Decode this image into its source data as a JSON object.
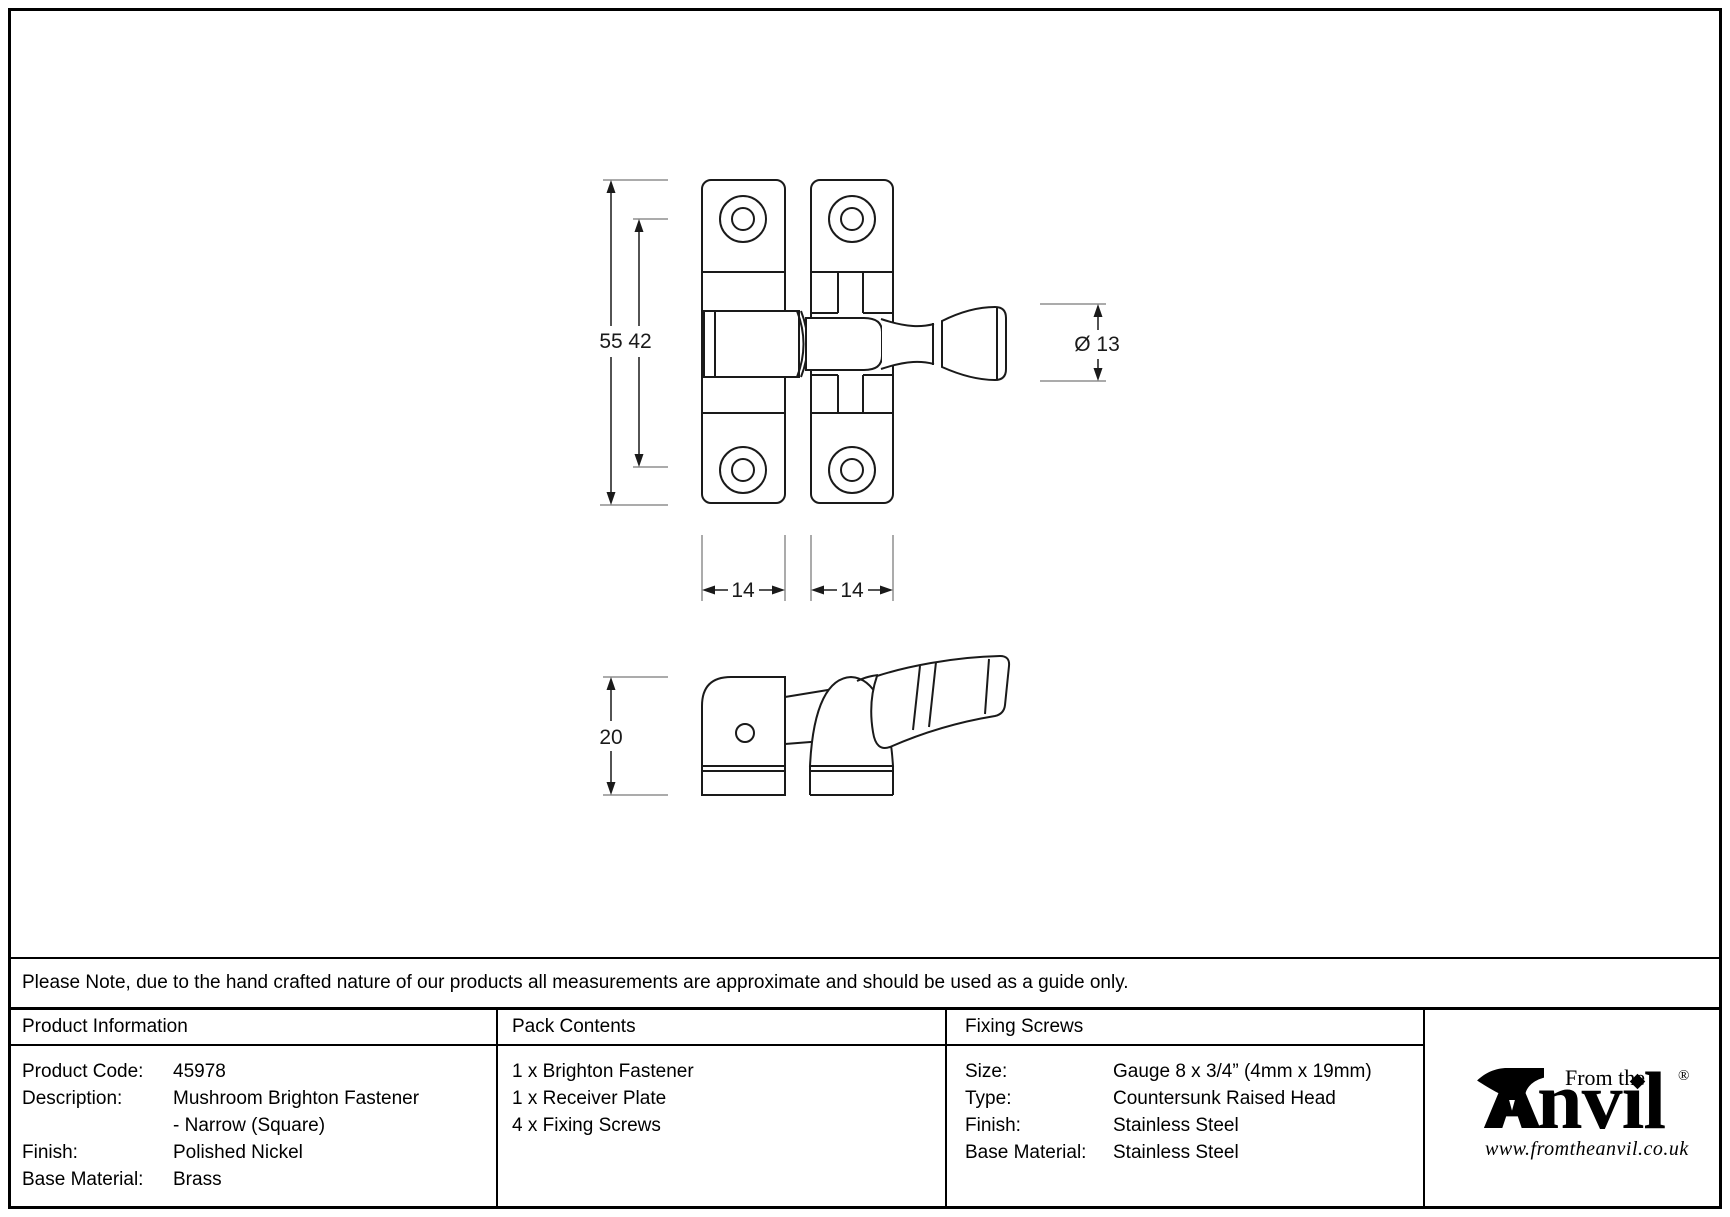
{
  "drawing": {
    "dims": {
      "overall_height": "55",
      "screw_spacing": "42",
      "receiver_width": "14",
      "base_width": "14",
      "knob_diameter": "Ø 13",
      "projection": "20"
    }
  },
  "note": {
    "text": "Please Note, due to the hand crafted nature of our products all measurements are approximate and should be used as a guide only."
  },
  "table": {
    "product_information": {
      "title": "Product Information",
      "rows": [
        {
          "label": "Product Code:",
          "value": "45978"
        },
        {
          "label": "Description:",
          "value": "Mushroom Brighton Fastener"
        },
        {
          "label": "",
          "value": "- Narrow (Square)"
        },
        {
          "label": "Finish:",
          "value": "Polished Nickel"
        },
        {
          "label": "Base Material:",
          "value": "Brass"
        }
      ]
    },
    "pack_contents": {
      "title": "Pack Contents",
      "items": [
        "1 x Brighton Fastener",
        "1 x Receiver Plate",
        "4 x Fixing Screws"
      ]
    },
    "fixing_screws": {
      "title": "Fixing Screws",
      "rows": [
        {
          "label": "Size:",
          "value": "Gauge 8 x 3/4” (4mm x 19mm)"
        },
        {
          "label": "Type:",
          "value": "Countersunk Raised Head"
        },
        {
          "label": "Finish:",
          "value": "Stainless Steel"
        },
        {
          "label": "Base Material:",
          "value": "Stainless Steel"
        }
      ]
    }
  },
  "logo": {
    "wordmark": "Anvil",
    "wordmark_rest": "nvıl",
    "from_the": "From the",
    "registered": "®",
    "website": "www.fromtheanvil.co.uk",
    "color": "#000000"
  }
}
